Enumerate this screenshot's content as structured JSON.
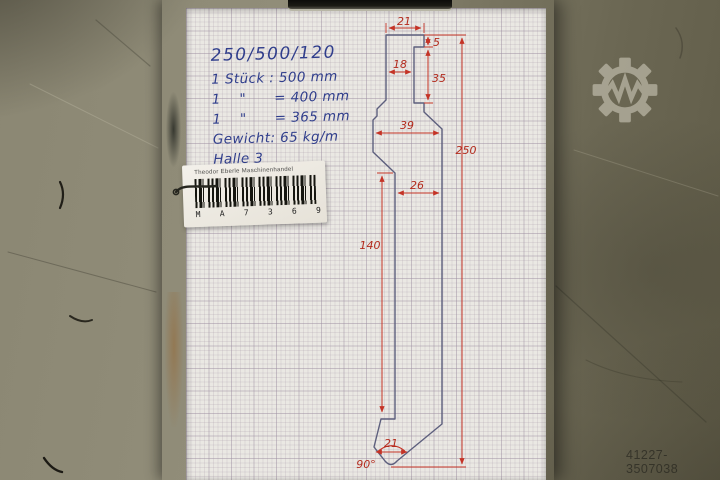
{
  "photo": {
    "watermark_id": "41227-3507038"
  },
  "notes": {
    "title": "250/500/120",
    "lines": [
      "1 Stück : 500 mm",
      "1    \"      = 400 mm",
      "1    \"      = 365 mm",
      "Gewicht: 65 kg/m",
      "Halle 3"
    ]
  },
  "label": {
    "company": "Theodor Eberle Maschinenhandel",
    "code": "M    A    7    3    6    9"
  },
  "drawing": {
    "labels": {
      "top_width": "21",
      "groove_offset": "5",
      "head_step": "18",
      "groove_height": "35",
      "shoulder_width": "39",
      "overall_height": "250",
      "shaft_width": "26",
      "shaft_length": "140",
      "tip_width": "21",
      "tip_angle": "90°"
    },
    "colors": {
      "outline": "#5d5f7d",
      "dimension": "#c43326",
      "ink": "#303e8c"
    }
  }
}
